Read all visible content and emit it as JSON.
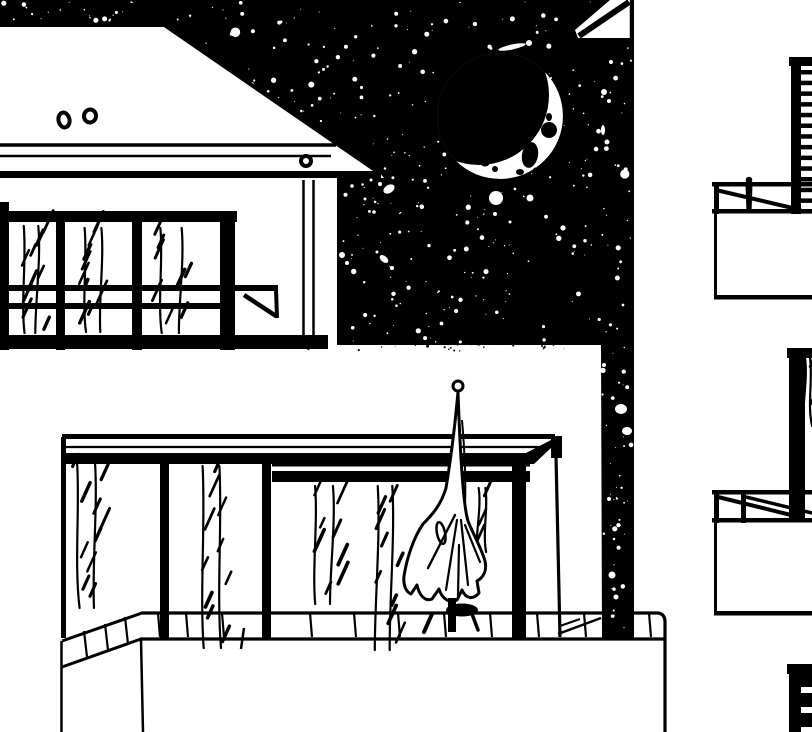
{
  "scene": {
    "type": "ink-illustration",
    "subject": "night view of modern building balconies with moon and starry sky",
    "width": 812,
    "height": 732
  },
  "palette": {
    "ink": "#000000",
    "paper": "#ffffff"
  },
  "moon": {
    "cx": 500,
    "cy": 116,
    "r": 63,
    "shadow": {
      "cx": 479,
      "cy": 95,
      "r": 70
    },
    "blotches": [
      {
        "cx": 530,
        "cy": 155,
        "rx": 8,
        "ry": 13,
        "rot": 10
      },
      {
        "cx": 549,
        "cy": 130,
        "rx": 8,
        "ry": 8,
        "rot": 0
      },
      {
        "cx": 506,
        "cy": 141,
        "rx": 7,
        "ry": 6,
        "rot": 0
      },
      {
        "cx": 543,
        "cy": 104,
        "rx": 4,
        "ry": 8,
        "rot": 15
      },
      {
        "cx": 549,
        "cy": 117,
        "rx": 3,
        "ry": 4,
        "rot": 0
      },
      {
        "cx": 461,
        "cy": 148,
        "rx": 3,
        "ry": 2.5,
        "rot": 0
      },
      {
        "cx": 472,
        "cy": 156,
        "rx": 4,
        "ry": 3,
        "rot": 20
      },
      {
        "cx": 485,
        "cy": 163,
        "rx": 4.5,
        "ry": 3.5,
        "rot": 0
      },
      {
        "cx": 495,
        "cy": 169,
        "rx": 3,
        "ry": 3,
        "rot": 0
      },
      {
        "cx": 520,
        "cy": 172,
        "rx": 4,
        "ry": 3,
        "rot": 0
      },
      {
        "cx": 536,
        "cy": 170,
        "rx": 3,
        "ry": 2.5,
        "rot": 0
      },
      {
        "cx": 518,
        "cy": 146,
        "rx": 4,
        "ry": 3,
        "rot": 0
      }
    ]
  },
  "star_field": {
    "maxR": 2.2,
    "regions": [
      {
        "name": "main-sky",
        "seed": 42,
        "x0": 160,
        "x1": 633,
        "y0": 2,
        "y1": 342,
        "count": 430,
        "clip": "diag"
      },
      {
        "name": "above-roof",
        "seed": 7,
        "x0": 2,
        "x1": 160,
        "y0": 2,
        "y1": 21,
        "count": 22
      },
      {
        "name": "between-buildings",
        "seed": 11,
        "x0": 601,
        "x1": 632,
        "y0": 346,
        "y1": 634,
        "count": 40
      }
    ]
  },
  "splashes": [
    {
      "x": 496,
      "y": 198,
      "r": 7
    },
    {
      "x": 530,
      "y": 198,
      "r": 3.5
    },
    {
      "x": 389,
      "y": 189,
      "rx": 6,
      "ry": 4,
      "rot": -30
    },
    {
      "x": 380,
      "y": 184,
      "r": 2
    },
    {
      "x": 371,
      "y": 180,
      "r": 1.5
    },
    {
      "x": 345,
      "y": 166,
      "r": 2.5
    },
    {
      "x": 356,
      "y": 171,
      "r": 1.5
    },
    {
      "x": 342,
      "y": 255,
      "r": 3
    },
    {
      "x": 347,
      "y": 263,
      "r": 2
    },
    {
      "x": 384,
      "y": 259,
      "rx": 5,
      "ry": 3,
      "rot": 40
    },
    {
      "x": 392,
      "y": 268,
      "r": 2
    },
    {
      "x": 377,
      "y": 252,
      "r": 1.5
    },
    {
      "x": 512,
      "y": 47,
      "rx": 14,
      "ry": 2.5,
      "rot": -12
    },
    {
      "x": 529,
      "y": 43,
      "r": 3
    },
    {
      "x": 604,
      "y": 92,
      "r": 3
    },
    {
      "x": 609,
      "y": 101,
      "r": 2
    },
    {
      "x": 603,
      "y": 130,
      "rx": 2,
      "ry": 5,
      "rot": 0
    },
    {
      "x": 607,
      "y": 142,
      "r": 2.5
    },
    {
      "x": 611,
      "y": 62,
      "r": 2
    },
    {
      "x": 621,
      "y": 409,
      "rx": 6,
      "ry": 5,
      "rot": 0
    },
    {
      "x": 627,
      "y": 431,
      "rx": 5,
      "ry": 4,
      "rot": 0
    },
    {
      "x": 609,
      "y": 499,
      "r": 2
    },
    {
      "x": 612,
      "y": 575,
      "r": 3.5
    },
    {
      "x": 616,
      "y": 597,
      "r": 2.5
    },
    {
      "x": 604,
      "y": 365,
      "r": 2
    },
    {
      "x": 495,
      "y": 214,
      "r": 2
    },
    {
      "x": 510,
      "y": 222,
      "r": 1.5
    },
    {
      "x": 352,
      "y": 186,
      "r": 1.8
    },
    {
      "x": 365,
      "y": 199,
      "r": 1.5
    },
    {
      "x": 374,
      "y": 212,
      "r": 1.8
    }
  ],
  "wall_noise": {
    "seed": 77,
    "count": 40,
    "x0": 306,
    "x1": 598,
    "y0": 341,
    "y1": 351,
    "maxR": 1.1
  },
  "curtains": [
    {
      "x": 18,
      "top": 226,
      "bottom": 333,
      "width": 26,
      "hatches": 9,
      "seed": 1
    },
    {
      "x": 78,
      "top": 228,
      "bottom": 332,
      "width": 30,
      "hatches": 9,
      "seed": 2
    },
    {
      "x": 152,
      "top": 228,
      "bottom": 333,
      "width": 38,
      "hatches": 8,
      "seed": 3
    },
    {
      "x": 70,
      "top": 462,
      "bottom": 608,
      "width": 32,
      "hatches": 10,
      "seed": 4
    },
    {
      "x": 196,
      "top": 466,
      "bottom": 648,
      "width": 30,
      "hatches": 10,
      "seed": 5
    },
    {
      "x": 308,
      "top": 486,
      "bottom": 604,
      "width": 32,
      "hatches": 8,
      "seed": 6
    },
    {
      "x": 372,
      "top": 486,
      "bottom": 650,
      "width": 26,
      "hatches": 9,
      "seed": 7
    },
    {
      "x": 476,
      "top": 488,
      "bottom": 552,
      "width": 12,
      "hatches": 3,
      "seed": 8
    },
    {
      "x": 803,
      "top": 358,
      "bottom": 426,
      "width": 9,
      "hatches": 2,
      "seed": 9
    }
  ],
  "ledge_ticks": {
    "vertical": [
      158,
      186,
      222,
      310,
      354,
      398,
      444,
      490,
      537,
      584,
      628,
      649
    ],
    "sloped": [
      [
        84,
        631,
        87,
        657
      ],
      [
        105,
        624,
        108,
        650
      ],
      [
        125,
        617,
        128,
        644
      ]
    ]
  },
  "louvers": {
    "top": {
      "x": 801,
      "w": 11,
      "y0": 70,
      "pitch": 10.7,
      "count": 14,
      "h": 4.5
    },
    "bottom_slats": {
      "x": 801,
      "w": 11,
      "h": 6,
      "ys": [
        687,
        707,
        727
      ]
    }
  }
}
